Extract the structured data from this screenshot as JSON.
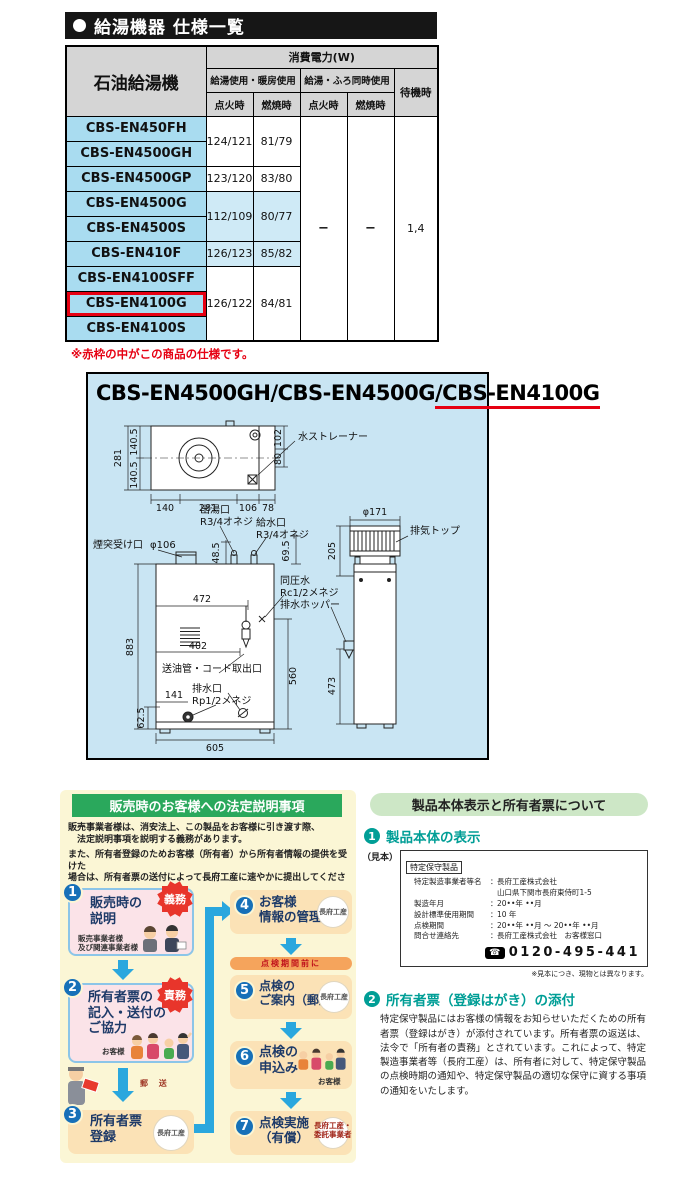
{
  "spec": {
    "section_title": "給湯機器 仕様一覧",
    "col_product": "石油給湯機",
    "col_power": "消費電力(W)",
    "col_g1": "給湯使用・暖房使用",
    "col_g2": "給湯・ふろ同時使用",
    "col_standby": "待機時",
    "col_ign1": "点火時",
    "col_burn1": "燃焼時",
    "col_ign2": "点火時",
    "col_burn2": "燃焼時",
    "models": [
      "CBS-EN450FH",
      "CBS-EN4500GH",
      "CBS-EN4500GP",
      "CBS-EN4500G",
      "CBS-EN4500S",
      "CBS-EN410F",
      "CBS-EN4100SFF",
      "CBS-EN4100G",
      "CBS-EN4100S"
    ],
    "v": {
      "a1": "124/121",
      "a2": "81/79",
      "b1": "123/120",
      "b2": "83/80",
      "c1": "112/109",
      "c2": "80/77",
      "d1": "126/123",
      "d2": "85/82",
      "e1": "126/122",
      "e2": "84/81",
      "dash": "−",
      "standby": "1,4"
    },
    "note": "※赤枠の中がこの商品の仕様です。"
  },
  "diagram": {
    "title_plain": "CBS-EN4500GH/CBS-EN4500G",
    "title_highlight": "/CBS-EN4100G",
    "top": {
      "d281": "281",
      "d1405a": "140.5",
      "d1405b": "140.5",
      "d102": "102",
      "d80": "80",
      "b140": "140",
      "b281": "281",
      "b106": "106",
      "b78": "78",
      "strainer": "水ストレーナー"
    },
    "front": {
      "outlet": "出湯口",
      "outlet_thread": "R3/4オネジ",
      "inlet": "給水口",
      "inlet_thread": "R3/4オネジ",
      "chimney": "煙突受け口",
      "chimney_dia": "φ106",
      "d485": "48.5",
      "d695": "69.5",
      "equal": "同圧水",
      "equal_thread": "Rc1/2メネジ",
      "hopper": "排水ホッパー",
      "d472": "472",
      "d402": "402",
      "d883": "883",
      "oil_outlet": "送油管・コード取出口",
      "drain": "排水口",
      "drain_thread": "Rp1/2メネジ",
      "d141": "141",
      "d625": "62.5",
      "d605": "605",
      "d560": "560"
    },
    "side": {
      "dia171": "φ171",
      "exhaust": "排気トップ",
      "d205": "205",
      "d473": "473"
    }
  },
  "legal": {
    "title": "販売時のお客様への法定説明事項",
    "intro1": "販売事業者様は、消安法上、この製品をお客様に引き渡す際、\n　法定説明事項を説明する義務があります。",
    "intro2": "また、所有者登録のためお客様（所有者）から所有者情報の提供を受けた\n場合は、所有者票の送付によって長府工産に速やかに提出してください。",
    "steps": {
      "s1": {
        "num": "1",
        "title": "販売時の\n説明",
        "badge": "義務",
        "caption": "販売事業者様\n及び関連事業者様"
      },
      "s2": {
        "num": "2",
        "title": "所有者票の\n記入・送付の\nご協力",
        "badge": "責務",
        "caption": "お客様"
      },
      "s3": {
        "num": "3",
        "title": "所有者票\n登録",
        "org": "長府工産"
      },
      "s4": {
        "num": "4",
        "title": "お客様\n情報の管理",
        "org": "長府工産"
      },
      "s5": {
        "num": "5",
        "title": "点検の\nご案内（郵送）",
        "org": "長府工産"
      },
      "s6": {
        "num": "6",
        "title": "点検の\n申込み",
        "caption": "お客様"
      },
      "s7": {
        "num": "7",
        "title": "点検実施\n（有償）",
        "org_caption": "長府工産・\n委託事業者"
      }
    },
    "mail_label": "郵 送",
    "before_bar": "点検期間前に"
  },
  "owner": {
    "title": "製品本体表示と所有者票について",
    "s1_num": "1",
    "s1_title": "製品本体の表示",
    "sample_label": "（見本）",
    "plate": {
      "tag": "特定保守製品",
      "sep": "：",
      "rows": [
        {
          "k": "特定製造事業者等名",
          "v": "長府工産株式会社"
        },
        {
          "k": "",
          "v": "山口県下関市長府東侍町1-5"
        },
        {
          "k": "製造年月",
          "v": "20••年 ••月"
        },
        {
          "k": "設計標準使用期間",
          "v": "10 年"
        },
        {
          "k": "点検期間",
          "v": "20••年 ••月 ～ 20••年 ••月"
        },
        {
          "k": "問合せ連絡先",
          "v": "長府工産株式会社　お客様窓口"
        }
      ],
      "phone": "0120-495-441"
    },
    "plate_note": "※見本につき、現物とは異なります。",
    "s2_num": "2",
    "s2_title": "所有者票（登録はがき）の添付",
    "s2_body": "特定保守製品にはお客様の情報をお知らせいただくための所有者票（登録はがき）が添付されています。所有者票の返送は、法令で「所有者の責務」とされています。これによって、特定製造事業者等（長府工産）は、所有者に対して、特定保守製品の点検時期の通知や、特定保守製品の適切な保守に資する事項の通知をいたします。"
  }
}
